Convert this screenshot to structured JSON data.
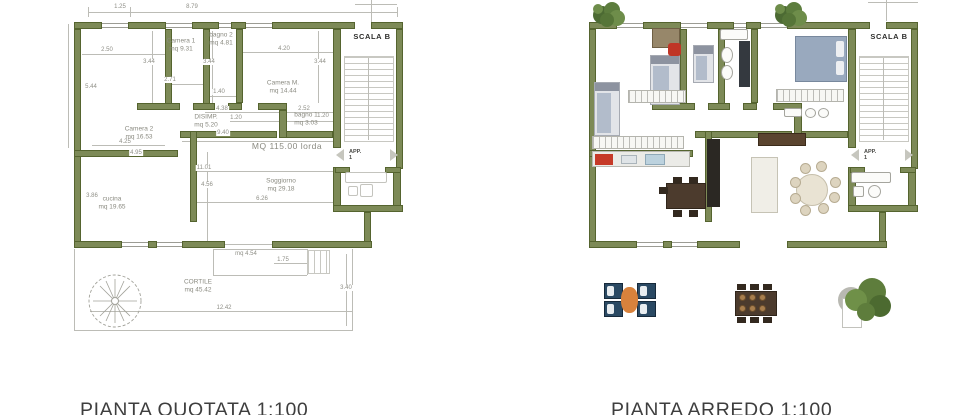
{
  "captions": {
    "left": "PIANTA QUOTATA 1:100",
    "right": "PIANTA ARREDO 1:100"
  },
  "colors": {
    "wall": "#7d8a57",
    "grass": "#a7bb7b",
    "tile": "#c1c1bd",
    "dim_text": "#8f8f87"
  },
  "plan_quotata": {
    "total_label": "MQ 115.00 lorda",
    "scala_label": "SCALA B",
    "app_label": "APP.",
    "app_number": "1",
    "rooms": [
      {
        "name": "Camera 1",
        "area": "mq 9.31",
        "x": 181,
        "y": 46
      },
      {
        "name": "bagno 2",
        "area": "mq 4.81",
        "x": 221,
        "y": 40
      },
      {
        "name": "Camera M.",
        "area": "mq 14.44",
        "x": 283,
        "y": 88
      },
      {
        "name": "Camera 2",
        "area": "mq 16.53",
        "x": 139,
        "y": 134
      },
      {
        "name": "DISIMP.",
        "area": "mq 5.20",
        "x": 206,
        "y": 122
      },
      {
        "name": "bagno 1",
        "area": "mq 3.03",
        "x": 306,
        "y": 120
      },
      {
        "name": "cucina",
        "area": "mq 19.65",
        "x": 112,
        "y": 204
      },
      {
        "name": "Soggiorno",
        "area": "mq 29.18",
        "x": 281,
        "y": 186
      },
      {
        "name": "CORTILE",
        "area": "mq 45.42",
        "x": 198,
        "y": 287
      }
    ],
    "dims": [
      {
        "t": "1.25",
        "x": 120,
        "y": 7
      },
      {
        "t": "8.79",
        "x": 192,
        "y": 7
      },
      {
        "t": "2.50",
        "x": 107,
        "y": 50
      },
      {
        "t": "3.44",
        "x": 149,
        "y": 62
      },
      {
        "t": "3.44",
        "x": 209,
        "y": 62
      },
      {
        "t": "3.44",
        "x": 320,
        "y": 62
      },
      {
        "t": "4.20",
        "x": 284,
        "y": 49
      },
      {
        "t": "5.44",
        "x": 91,
        "y": 87
      },
      {
        "t": "2.71",
        "x": 170,
        "y": 80
      },
      {
        "t": "1.40",
        "x": 219,
        "y": 92
      },
      {
        "t": "4.38",
        "x": 222,
        "y": 109
      },
      {
        "t": "2.52",
        "x": 304,
        "y": 109
      },
      {
        "t": "1.20",
        "x": 236,
        "y": 118
      },
      {
        "t": "1.20",
        "x": 323,
        "y": 116
      },
      {
        "t": "9.40",
        "x": 223,
        "y": 133
      },
      {
        "t": "4.25",
        "x": 125,
        "y": 142
      },
      {
        "t": "4.95",
        "x": 136,
        "y": 153
      },
      {
        "t": "11.01",
        "x": 204,
        "y": 168
      },
      {
        "t": "3.86",
        "x": 92,
        "y": 196
      },
      {
        "t": "4.56",
        "x": 207,
        "y": 185
      },
      {
        "t": "6.26",
        "x": 262,
        "y": 199
      },
      {
        "t": "mq 4.54",
        "x": 246,
        "y": 254
      },
      {
        "t": "1.75",
        "x": 283,
        "y": 260
      },
      {
        "t": "12.42",
        "x": 224,
        "y": 308
      },
      {
        "t": "3.40",
        "x": 346,
        "y": 288
      }
    ]
  },
  "plan_arredo": {
    "scala_label": "SCALA B",
    "app_label": "APP.",
    "app_number": "1"
  }
}
